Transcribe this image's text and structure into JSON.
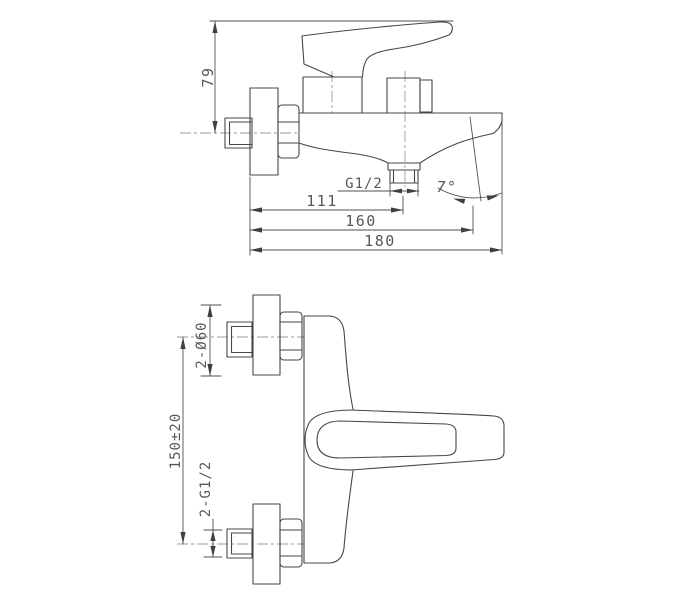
{
  "drawing_title": "wall-mounted single-lever bath mixer — dimensioned technical drawing, two views",
  "colors": {
    "background": "#ffffff",
    "part_line": "#474747",
    "dimension_line": "#4f4f4f",
    "centerline": "#9b9b9b",
    "text": "#585858"
  },
  "views": {
    "side": {
      "label": "side elevation",
      "dims": {
        "handle_height": "79",
        "outlet_thread": "G1/2",
        "outlet_offset": "111",
        "spout_reach": "160",
        "overall_depth": "180",
        "face_angle": "7°"
      }
    },
    "plan": {
      "label": "plan view",
      "dims": {
        "flange_diameter": "2-Ø60",
        "inlet_spacing": "150±20",
        "inlet_thread": "2-G1/2"
      }
    }
  }
}
